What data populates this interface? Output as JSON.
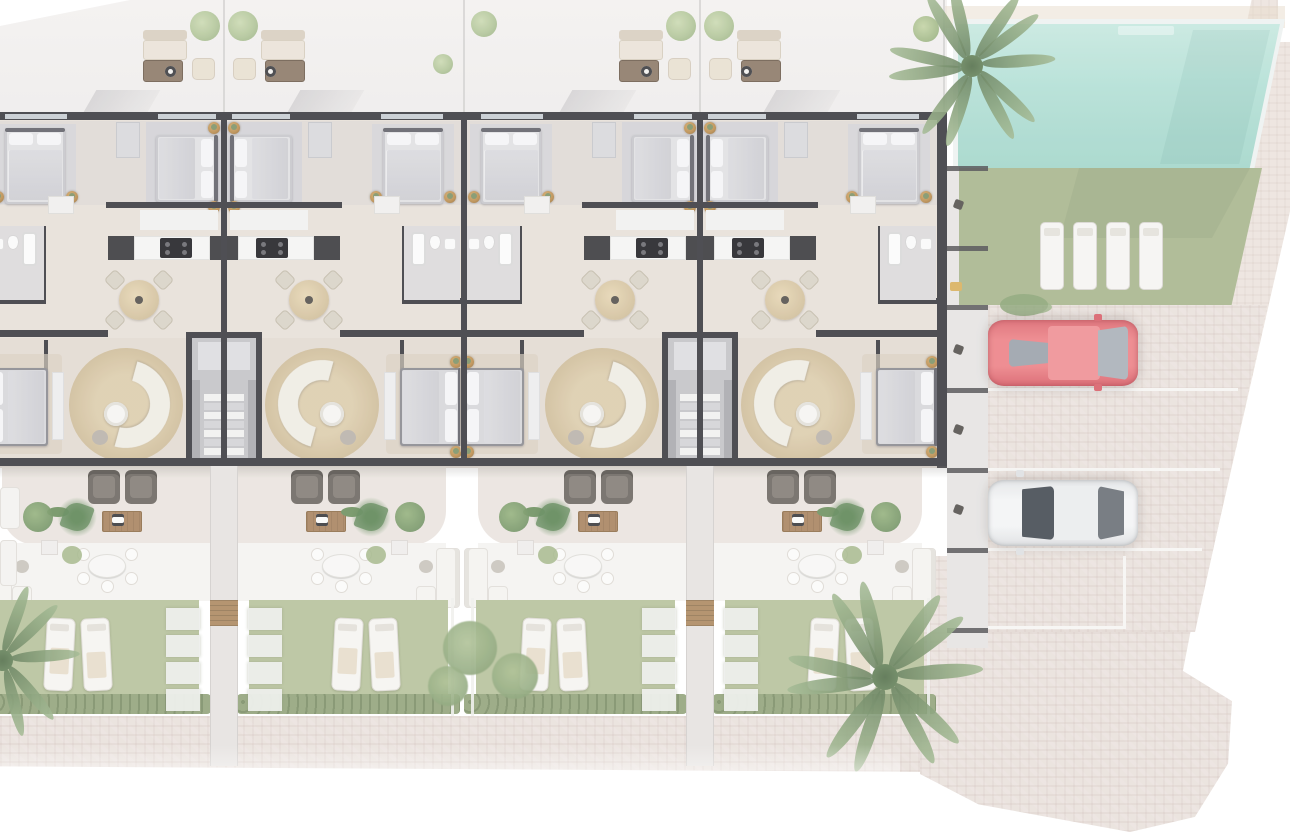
{
  "page": {
    "title": "Residential development site plan — top-down architectural render, ground floor",
    "view": "top-down floor plan",
    "visible_text": "none"
  },
  "site": {
    "units": [
      {
        "id": "unit-1",
        "label": "Unit 1",
        "note": "left edge, partially cropped",
        "bedrooms": 3,
        "bathrooms": 1,
        "features": [
          "top terrace lounge set",
          "kitchen with hob",
          "round dining table with 4 chairs",
          "round jute rug with curved sofa",
          "lower terrace with 2 armchairs and barbecue table",
          "outdoor dining patio",
          "private garden with 2 sun loungers",
          "palm tree"
        ]
      },
      {
        "id": "unit-2",
        "label": "Unit 2",
        "note": "mirrored pair with unit 1 around shared stairwell",
        "bedrooms": 3,
        "bathrooms": 1,
        "features": [
          "top terrace lounge set",
          "kitchen with hob",
          "round dining table with 4 chairs",
          "round jute rug with curved sofa",
          "lower terrace with 2 armchairs and barbecue table",
          "outdoor dining patio",
          "private garden with 2 sun loungers"
        ]
      },
      {
        "id": "unit-3",
        "label": "Unit 3",
        "note": "mirrored pair with unit 4 around shared stairwell",
        "bedrooms": 3,
        "bathrooms": 1,
        "features": [
          "top terrace lounge set",
          "kitchen with hob",
          "round dining table with 4 chairs",
          "round jute rug with curved sofa",
          "lower terrace with 2 armchairs and barbecue table",
          "outdoor dining patio",
          "private garden with 2 sun loungers",
          "garden shrub cluster"
        ]
      },
      {
        "id": "unit-4",
        "label": "Unit 4",
        "note": "corner unit beside communal pool and parking",
        "bedrooms": 3,
        "bathrooms": 2,
        "features": [
          "top terrace lounge set",
          "kitchen with hob",
          "round dining table with 4 chairs",
          "round jute rug with curved sofa",
          "lower terrace with 2 armchairs and barbecue table",
          "outdoor dining patio",
          "private garden with 2 sun loungers"
        ]
      }
    ],
    "shared_amenities": {
      "stairwells": 2,
      "pool": {
        "description": "communal swimming pool, rectangular with angled right edge",
        "loungers": 4,
        "water_color": "#aedcd3"
      },
      "pool_lawn": {
        "description": "communal lawn below pool",
        "loungers_on_lawn": 4
      },
      "parking": {
        "spaces": 4,
        "occupied": 2,
        "empty": 2,
        "cars": [
          {
            "space": 1,
            "color_name": "red",
            "color": "#e4666e"
          },
          {
            "space": 3,
            "color_name": "white",
            "color": "#eff0f1"
          }
        ]
      },
      "rear_patio_storage": {
        "description": "strip of small rear patios between building and parking",
        "bays": 5
      },
      "plaza": "cobbled pedestrian plaza at lower right with stepped boundary"
    },
    "vegetation": {
      "palm_trees": 3,
      "small_round_trees": 4,
      "garden_shrubs": 6,
      "garden_hedges": 4
    },
    "colors": {
      "walls": "#3c3c41",
      "interior_floor": "#e7e0d9",
      "bedroom_carpet": "#d3d3d7",
      "terrace_floor": "#f1efee",
      "lower_terrace_floor": "#eae4df",
      "patio_floor": "#f4f3f1",
      "garden_lawn": "#b7c29c",
      "hedge": "#93a47c",
      "pool_lawn": "#a9b68e",
      "pool_water": "#aedcd3",
      "pool_coping": "#eef2f1",
      "cobble_paving": "#e9e1dc",
      "jute_rug": "#d2c09d",
      "wood_furniture": "#a98460",
      "brass_planter": "#b98c4e",
      "armchair": "#6e6862",
      "red_car": "#e4666e",
      "white_car": "#eff0f1",
      "palm_foliage": "#7d9770",
      "tree_foliage": "#aec394"
    }
  }
}
